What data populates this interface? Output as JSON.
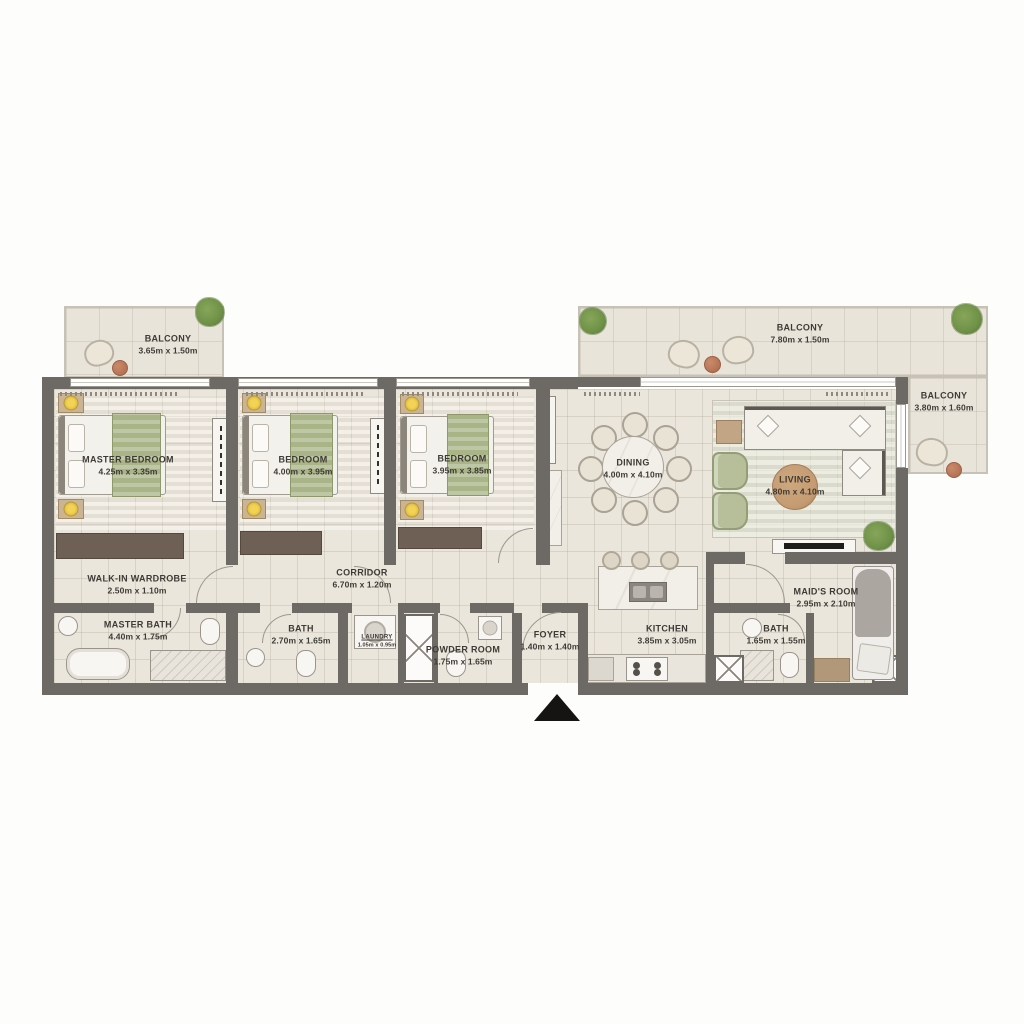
{
  "plan_title": "apartment-floor-plan",
  "rooms": {
    "balcony_tl": {
      "name": "BALCONY",
      "dims": "3.65m x 1.50m"
    },
    "master_bedroom": {
      "name": "MASTER BEDROOM",
      "dims": "4.25m x 3.35m"
    },
    "bedroom_2": {
      "name": "BEDROOM",
      "dims": "4.00m x 3.95m"
    },
    "bedroom_3": {
      "name": "BEDROOM",
      "dims": "3.95m x 3.85m"
    },
    "balcony_tr": {
      "name": "BALCONY",
      "dims": "7.80m x 1.50m"
    },
    "balcony_r": {
      "name": "BALCONY",
      "dims": "3.80m x 1.60m"
    },
    "dining": {
      "name": "DINING",
      "dims": "4.00m x 4.10m"
    },
    "living": {
      "name": "LIVING",
      "dims": "4.80m x 4.10m"
    },
    "walk_in_wardrobe": {
      "name": "WALK-IN WARDROBE",
      "dims": "2.50m x 1.10m"
    },
    "corridor": {
      "name": "CORRIDOR",
      "dims": "6.70m x 1.20m"
    },
    "master_bath": {
      "name": "MASTER BATH",
      "dims": "4.40m x 1.75m"
    },
    "bath_2": {
      "name": "BATH",
      "dims": "2.70m x 1.65m"
    },
    "laundry": {
      "name": "LAUNDRY",
      "dims": "1.05m x 0.95m"
    },
    "powder_room": {
      "name": "POWDER ROOM",
      "dims": "1.75m x 1.65m"
    },
    "foyer": {
      "name": "FOYER",
      "dims": "1.40m x 1.40m"
    },
    "kitchen": {
      "name": "KITCHEN",
      "dims": "3.85m x 3.05m"
    },
    "maids_bath": {
      "name": "BATH",
      "dims": "1.65m x 1.55m"
    },
    "maids_room": {
      "name": "MAID'S ROOM",
      "dims": "2.95m x 2.10m"
    }
  },
  "icons": {
    "entrance_marker": "triangle-up",
    "plant": "green-blob",
    "shaft": "crossed-box"
  },
  "colors": {
    "wall": "#6d6a66",
    "floor": "#ebe6dc",
    "wood": "#6e6054",
    "throw_green": "#a9b487",
    "sage_chair": "#b7bf9a",
    "terracotta": "#b57356",
    "plant_green": "#6f9147",
    "text": "#3e3a35",
    "entrance": "#161412"
  }
}
